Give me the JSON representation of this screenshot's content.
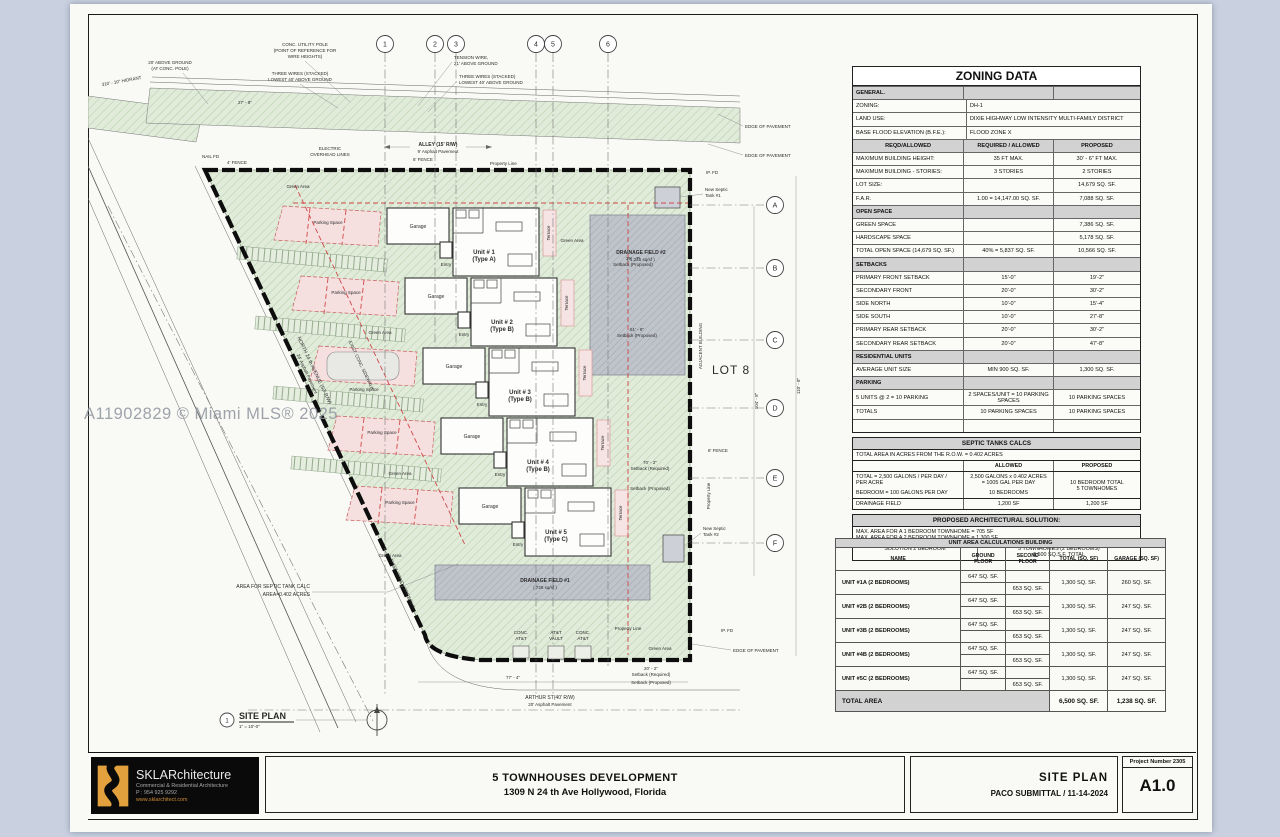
{
  "watermark": "A11902829 © Miami MLS® 2025",
  "plan": {
    "labels": {
      "hydrant": "310' - 10\" HIDRANT",
      "above1": "20' ABOVE GROUND",
      "above2": "(AT CONC. POLE)",
      "pole1": "CONC. UTILITY POLE",
      "pole2": "(POINT OF REFERENCE FOR",
      "pole3": "WIRE HEIGHTS)",
      "wires1a": "THREE WIRES (STACKED)",
      "wires1b": "LOWEST 40' ABOVE GROUND",
      "tension1": "TENSION WIRE,",
      "tension2": "21' ABOVE GROUND",
      "wires2a": "THREE WIRES (STACKED)",
      "wires2b": "LOWEST 40' ABOVE GROUND",
      "alley1": "ALLEY (15' R/W)",
      "alley2": "9' Asphalt Pavement",
      "electric1": "ELECTRIC",
      "electric2": "OVERHEAD LINES",
      "nailfd": "NAIL FD",
      "fence4": "4' FENCE",
      "fence6": "6' FENCE",
      "fence8": "8' FENCE",
      "proptop": "Property Line",
      "propbottom": "Property Line",
      "propright": "Property Line",
      "edge": "EDGE OF PAVEMENT",
      "ipfd": "IP. FD",
      "septic1a": "New Septic",
      "septic1b": "Tank #1",
      "septic2a": "New Septic",
      "septic2b": "Tank #2",
      "dr2a": "DRAINAGE FIELD #2",
      "dr2b": "( 1,225 sq/sf )",
      "dr1a": "DRAINAGE FIELD #1",
      "dr1b": "( 728 sq/sf )",
      "lot8": "LOT 8",
      "adjacent": "ADJACENT BUILDING",
      "road1": "NORTH 24 th AVENUE (50' R/W)",
      "road2": "24' Asphalt Pavement",
      "sidewalk": "EXIST. CONC. SIDEWALK",
      "arthur1": "ARTHUR ST(40' R/W)",
      "arthur2": "20' Asphalt Pavement",
      "concatt1a": "CONC.",
      "concatt1b": "AT&T",
      "vaulta": "AT&T",
      "vaultb": "VAULT",
      "septiccalc1": "AREA FOR SEPTIC TANK CALC",
      "septiccalc2": "AREA=0.402 ACRES",
      "siteplan": "SITE PLAN",
      "scale": "1\" = 10'-0\"",
      "viewnum": "1",
      "green": "Green Area",
      "parking": "Parking Space",
      "garage": "Garage",
      "entry": "Entry",
      "terrace": "Terrace",
      "setbackprop": "Setback (Proposed)",
      "setbackreq": "Setback (Required)"
    },
    "dims": {
      "d27": "27' - 8\"",
      "d39": "39' - 7\"",
      "d51": "51' - 8\"",
      "d70": "70' - 2\"",
      "d77": "77' - 4\"",
      "d104": "104' - 8\"",
      "d110": "110' - 8\"",
      "d20": "20' - 2\""
    },
    "units": [
      {
        "no": "Unit # 1",
        "type": "(Type A)"
      },
      {
        "no": "Unit # 2",
        "type": "(Type B)"
      },
      {
        "no": "Unit # 3",
        "type": "(Type B)"
      },
      {
        "no": "Unit # 4",
        "type": "(Type B)"
      },
      {
        "no": "Unit # 5",
        "type": "(Type C)"
      }
    ],
    "grid_numbers": [
      "1",
      "2",
      "3",
      "4",
      "5",
      "6"
    ],
    "grid_letters": [
      "A",
      "B",
      "C",
      "D",
      "E",
      "F"
    ]
  },
  "zoning": {
    "title": "ZONING DATA",
    "rows": [
      {
        "k": "section",
        "c": [
          "GENERAL.",
          "",
          ""
        ]
      },
      {
        "k": "data2",
        "c": [
          "ZONING:",
          "DH-1",
          ""
        ]
      },
      {
        "k": "data2",
        "c": [
          "LAND USE:",
          "DIXIE HIGHWAY LOW INTENSITY MULTI-FAMILY DISTRICT",
          ""
        ]
      },
      {
        "k": "data2",
        "c": [
          "BASE FLOOD ELEVATION (B.F.E.):",
          "FLOOD ZONE X",
          ""
        ]
      },
      {
        "k": "colhead",
        "c": [
          "REQD/ALLOWED",
          "REQUIRED / ALLOWED",
          "PROPOSED"
        ]
      },
      {
        "k": "data",
        "c": [
          "MAXIMUM BUILDING HEIGHT:",
          "35 FT MAX.",
          "30' - 6\" FT MAX."
        ]
      },
      {
        "k": "data",
        "c": [
          "MAXIMUM BUILDING - STORIES:",
          "3 STORIES",
          "2 STORIES"
        ]
      },
      {
        "k": "data",
        "c": [
          "LOT SIZE:",
          "",
          "14,679 SQ. SF."
        ]
      },
      {
        "k": "data",
        "c": [
          "F.A.R.",
          "1.00 = 14,147.00 SQ. SF.",
          "7,088 SQ. SF."
        ]
      },
      {
        "k": "section",
        "c": [
          "OPEN SPACE",
          "",
          ""
        ]
      },
      {
        "k": "data",
        "c": [
          "GREEN SPACE",
          "",
          "7,386 SQ. SF."
        ]
      },
      {
        "k": "data",
        "c": [
          "HARDSCAPE SPACE",
          "",
          "5,178 SQ. SF."
        ]
      },
      {
        "k": "data",
        "c": [
          "TOTAL OPEN SPACE (14,679 SQ. SF.)",
          "40% = 5,837  SQ. SF.",
          "10,566 SQ. SF."
        ]
      },
      {
        "k": "section",
        "c": [
          "SETBACKS",
          "",
          ""
        ]
      },
      {
        "k": "data",
        "c": [
          "PRIMARY FRONT SETBACK",
          "15'-0\"",
          "19'-2\""
        ]
      },
      {
        "k": "data",
        "c": [
          "SECONDARY FRONT",
          "20'-0\"",
          "30'-2\""
        ]
      },
      {
        "k": "data",
        "c": [
          "SIDE NORTH",
          "10'-0\"",
          "15'-4\""
        ]
      },
      {
        "k": "data",
        "c": [
          "SIDE SOUTH",
          "10'-0\"",
          "27'-8\""
        ]
      },
      {
        "k": "data",
        "c": [
          "PRIMARY REAR SETBACK",
          "20'-0\"",
          "30'-2\""
        ]
      },
      {
        "k": "data",
        "c": [
          "SECONDARY REAR SETBACK",
          "20'-0\"",
          "47'-8\""
        ]
      },
      {
        "k": "section",
        "c": [
          "RESIDENTIAL UNITS",
          "",
          ""
        ]
      },
      {
        "k": "data",
        "c": [
          "AVERAGE UNIT SIZE",
          "MIN 900 SQ. SF.",
          "1,300 SQ. SF."
        ]
      },
      {
        "k": "section",
        "c": [
          "PARKING",
          "",
          ""
        ]
      },
      {
        "k": "data",
        "c": [
          "5 UNITS @ 2 = 10 PARKING",
          "2 SPACES/UNIT = 10 PARKING SPACES",
          "10 PARKING SPACES"
        ]
      },
      {
        "k": "data",
        "c": [
          "TOTALS",
          "10  PARKING SPACES",
          "10  PARKING SPACES"
        ]
      },
      {
        "k": "data",
        "c": [
          "",
          "",
          ""
        ]
      }
    ]
  },
  "septic": {
    "title": "SEPTIC TANKS CALCS",
    "area_note": "TOTAL AREA IN ACRES FROM THE R.O.W.  = 0.402 ACRES",
    "col_allowed": "ALLOWED",
    "col_proposed": "PROPOSED",
    "calc_label_1": "TOTAL = 2,500 GALONS / PER DAY /",
    "calc_label_2": "PER ACRE",
    "calc_label_3": "BEDROOM = 100 GALONS PER DAY",
    "calc_allowed_1": "2,500 GALONS x 0.402 ACRES",
    "calc_allowed_2": "= 1005 GAL PER DAY",
    "calc_allowed_3": "10 BEDROOMS",
    "calc_proposed_1": "10 BEDROOM TOTAL",
    "calc_proposed_2": "5 TOWNHOMES",
    "drainage_label": "DRAINAGE FIELD",
    "drainage_allowed": "1,200 SF",
    "drainage_proposed": "1,200 SF"
  },
  "arch": {
    "title": "PROPOSED ARCHITECTURAL SOLUTION:",
    "note_1": "MAX. AREA FOR A 1 BEDROOM TOWNHOME =   705 SF",
    "note_2": "MAX. AREA FOR A 2 BEDROOM TOWNHOME = 1,300 SF",
    "solution_label": "SOLUTION 2 BEDROOM",
    "solution_value_1": "5 TOWNHOMES (2 BEDROOMS)",
    "solution_value_2": "6,500 SQ.S.F. TOTAL"
  },
  "unitArea": {
    "title": "UNIT AREA CALCULATIONS BUILDING",
    "headers": {
      "name": "NAME",
      "ground1": "GROUND",
      "ground2": "FLOOR",
      "second1": "SECOND",
      "second2": "FLOOR",
      "total": "TOTAL (SQ. SF)",
      "garage": "GARAGE (SQ. SF)"
    },
    "units": [
      {
        "name": "UNIT #1A (2 BEDROOMS)",
        "ground": "647 SQ. SF.",
        "second": "653 SQ. SF.",
        "total": "1,300 SQ. SF.",
        "garage": "260 SQ. SF."
      },
      {
        "name": "UNIT #2B (2 BEDROOMS)",
        "ground": "647 SQ. SF.",
        "second": "653 SQ. SF.",
        "total": "1,300 SQ. SF.",
        "garage": "247 SQ. SF."
      },
      {
        "name": "UNIT #3B (2 BEDROOMS)",
        "ground": "647 SQ. SF.",
        "second": "653 SQ. SF.",
        "total": "1,300 SQ. SF.",
        "garage": "247 SQ. SF."
      },
      {
        "name": "UNIT #4B (2 BEDROOMS)",
        "ground": "647 SQ. SF.",
        "second": "653 SQ. SF.",
        "total": "1,300 SQ. SF.",
        "garage": "247 SQ. SF."
      },
      {
        "name": "UNIT #5C (2 BEDROOMS)",
        "ground": "647 SQ. SF.",
        "second": "653 SQ. SF.",
        "total": "1,300 SQ. SF.",
        "garage": "247 SQ. SF."
      }
    ],
    "total_label": "TOTAL AREA",
    "total_total": "6,500 SQ. SF.",
    "total_garage": "1,238 SQ. SF."
  },
  "titleblock": {
    "firm": {
      "name": "SKLARchitecture",
      "tagline": "Commercial & Residential Architecture",
      "phone": "P : 954 925 9292",
      "web": "www.sklarchitect.com"
    },
    "project_line1": "5 TOWNHOUSES DEVELOPMENT",
    "project_line2": "1309 N 24 th Ave Hollywood, Florida",
    "sheet_title": "SITE PLAN",
    "submittal": "PACO SUBMITTAL  / 11-14-2024",
    "project_number": "Project Number 2305",
    "sheet_number": "A1.0"
  }
}
